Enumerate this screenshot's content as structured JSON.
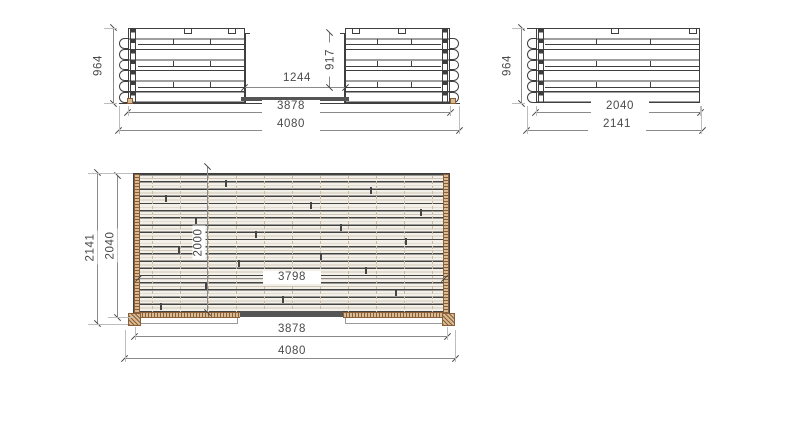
{
  "front_view": {
    "height": "964",
    "opening_width": "1244",
    "opening_height": "917",
    "inner_length": "3878",
    "overall_length": "4080"
  },
  "side_view": {
    "height": "964",
    "inner_length": "2040",
    "overall_length": "2141"
  },
  "plan_view": {
    "overall_depth": "2141",
    "inner_depth": "2040",
    "deck_depth": "2000",
    "deck_length": "3798",
    "inner_length": "3878",
    "overall_length": "4080"
  },
  "colors": {
    "line": "#3f3f3f",
    "dim": "#8a8a8a",
    "text": "#4a4a4a",
    "wood": "#d9bb93",
    "woodline": "#8a5f38",
    "threshold": "#555555",
    "deck_bg": "#f3f0ea"
  }
}
